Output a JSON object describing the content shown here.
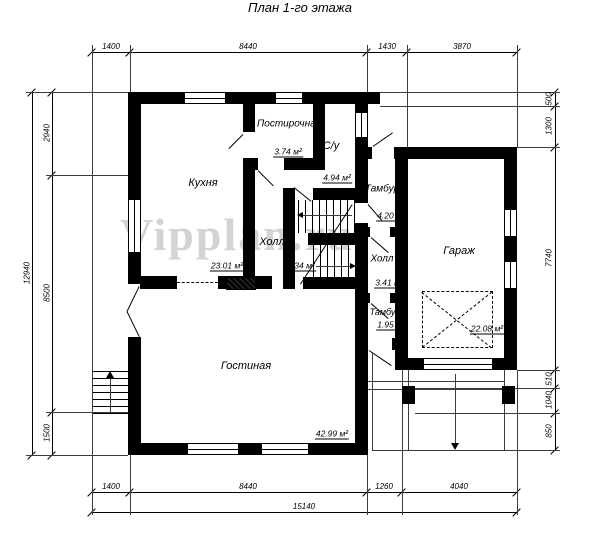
{
  "title": "План 1-го этажа",
  "watermark": "Vipplan.ru",
  "rooms": {
    "kitchen": {
      "label": "Кухня",
      "area": "23.01 м²"
    },
    "laundry": {
      "label": "Постирочная",
      "area": "3.74 м²"
    },
    "bathroom": {
      "label": "С/у",
      "area": "4.94 м²"
    },
    "vestibule_top": {
      "label": "Тамбур",
      "area": "4.20 м²"
    },
    "hall_main": {
      "label": "Холл",
      "area": "9.34 м²"
    },
    "hall_right": {
      "label": "Холл",
      "area": "3.41 м²"
    },
    "vestibule_bottom": {
      "label": "Тамбур",
      "area": "1.95 м²"
    },
    "garage": {
      "label": "Гараж",
      "area": "22.08 м²"
    },
    "living_room": {
      "label": "Гостиная",
      "area": "42.99 м²"
    }
  },
  "dimensions": {
    "top": [
      "1400",
      "8440",
      "1430",
      "3870"
    ],
    "bottom": [
      "1400",
      "8440",
      "1260",
      "4040"
    ],
    "bottom_total": "15140",
    "left": [
      "2940",
      "8500",
      "1500"
    ],
    "left_total": "12940",
    "right": [
      "500",
      "1300",
      "7740",
      "510",
      "1040",
      "850"
    ]
  },
  "colors": {
    "walls": "#000000",
    "watermark": "#c9c9c9",
    "background": "#ffffff"
  }
}
